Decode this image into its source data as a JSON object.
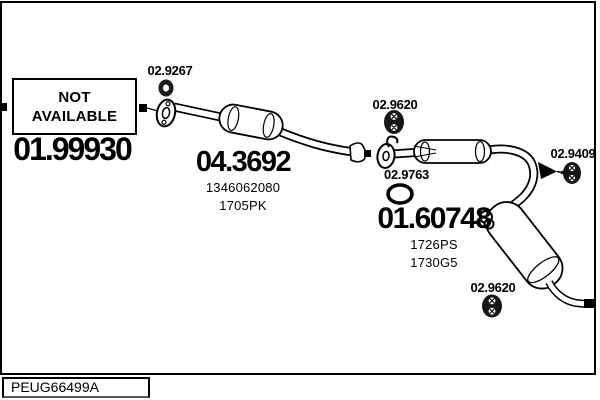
{
  "colors": {
    "ink": "#000000",
    "paper": "#ffffff"
  },
  "diagram": {
    "type": "exhaust-system-parts-diagram",
    "catalog_code": "PEUG66499A",
    "not_available_box": {
      "line1": "NOT",
      "line2": "AVAILABLE",
      "part_number": "01.99930"
    },
    "parts": {
      "front_mount_ring": {
        "number": "02.9267"
      },
      "catalytic_converter": {
        "number": "04.3692",
        "ref1": "1346062080",
        "ref2": "1705PK"
      },
      "centre_hanger": {
        "number": "02.9620"
      },
      "centre_gasket": {
        "number": "02.9763"
      },
      "rear_silencer": {
        "number": "01.60748",
        "ref1": "1726PS",
        "ref2": "1730G5"
      },
      "tail_hanger": {
        "number": "02.9409"
      },
      "rear_hanger": {
        "number": "02.9620"
      }
    }
  }
}
